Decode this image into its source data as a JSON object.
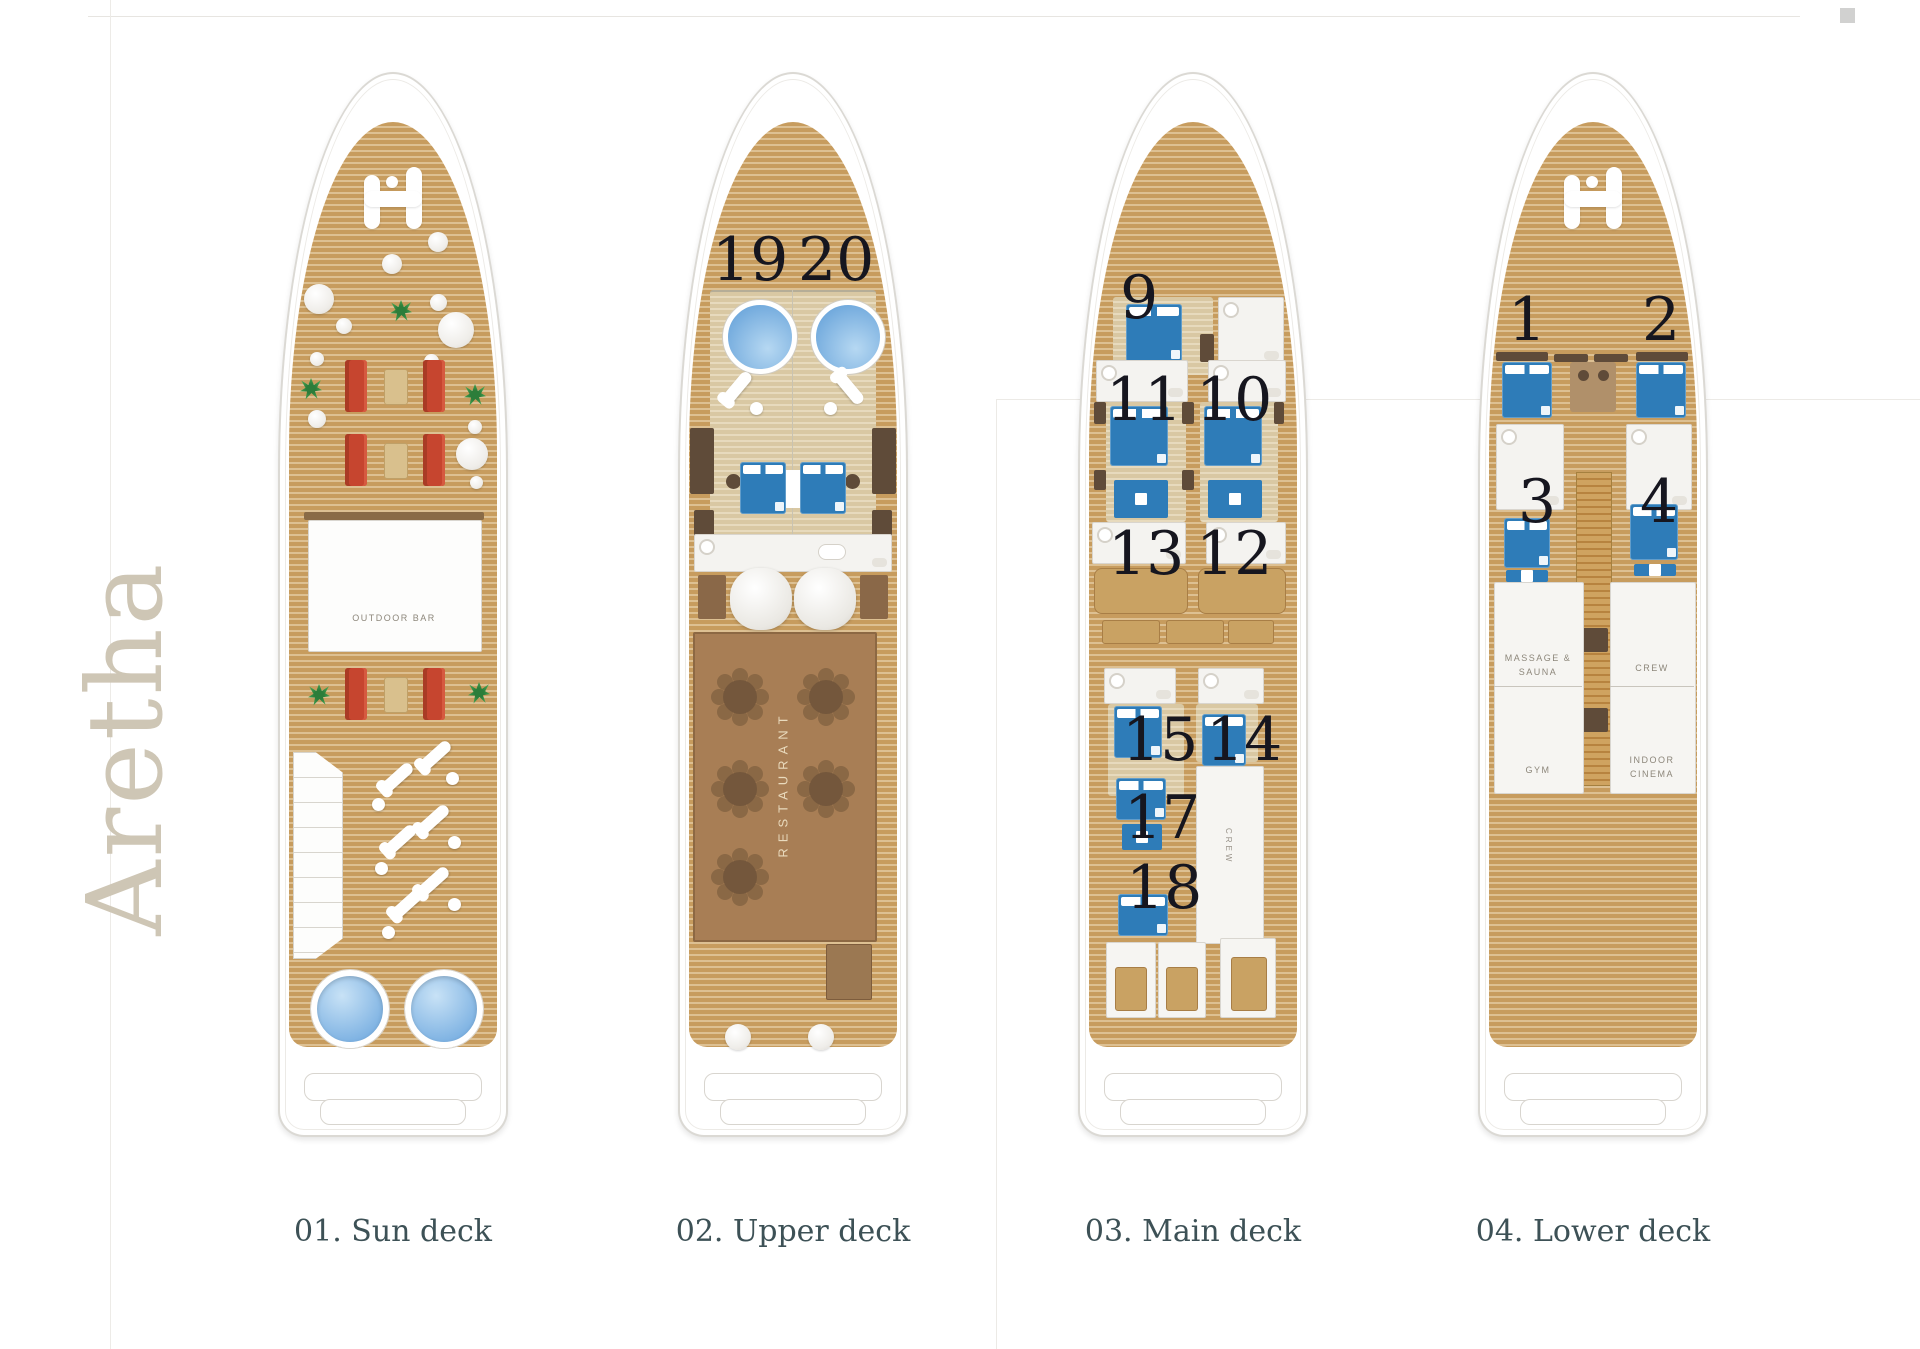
{
  "brand": {
    "name": "Aretha"
  },
  "palette": {
    "deck_wood": "#c79c5e",
    "deck_wood_stripe": "#ddc092",
    "hull_white": "#ffffff",
    "hull_border": "#dbd9d4",
    "sofa_red": "#c6452f",
    "bed_blue": "#2e7cb8",
    "pool_blue": "#6fa8dc",
    "restaurant_brown": "#a87e55",
    "plant_green": "#43a251",
    "number_color": "#16161f",
    "deck_label_color": "#3d5156",
    "brand_color": "#cec6b5"
  },
  "decks": {
    "sun": {
      "label": "01. Sun deck",
      "areas": {
        "outdoor_bar": "OUTDOOR BAR"
      }
    },
    "upper": {
      "label": "02. Upper deck",
      "areas": {
        "restaurant": "RESTAURANT"
      },
      "cabins": {
        "c19": "19",
        "c20": "20"
      }
    },
    "main": {
      "label": "03. Main deck",
      "areas": {
        "crew": "CREW"
      },
      "cabins": {
        "c9": "9",
        "c10": "10",
        "c11": "11",
        "c12": "12",
        "c13": "13",
        "c14": "14",
        "c15": "15",
        "c17": "17",
        "c18": "18"
      }
    },
    "lower": {
      "label": "04. Lower deck",
      "areas": {
        "massage_sauna": "MASSAGE &\nSAUNA",
        "crew": "CREW",
        "gym": "GYM",
        "indoor_cinema": "INDOOR\nCINEMA"
      },
      "cabins": {
        "c1": "1",
        "c2": "2",
        "c3": "3",
        "c4": "4"
      }
    }
  }
}
